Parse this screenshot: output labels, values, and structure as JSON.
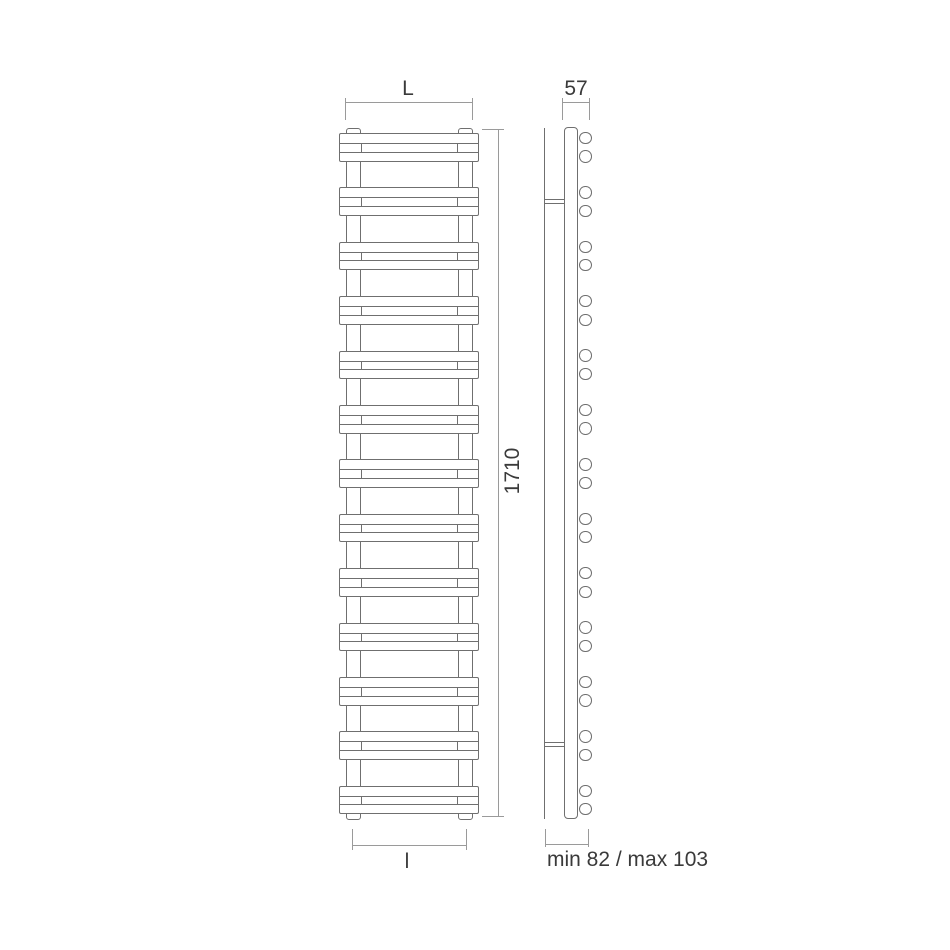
{
  "drawing": {
    "type": "technical-drawing",
    "subject": "vertical towel-warmer radiator, front elevation and side elevation with dimensions",
    "labels": {
      "width": "L",
      "height": "1710",
      "interaxis": "l",
      "depth": "57",
      "wall_distance": "min 82 / max 103"
    },
    "front_view": {
      "bar_pairs": 13,
      "bars_total": 26,
      "collectors": 2
    },
    "side_view": {
      "bar_end_circles": 26,
      "wall_brackets": 2
    },
    "colors": {
      "object_line": "#6f6f6f",
      "dimension_line": "#9a9a9a",
      "text": "#3a3a3c",
      "background": "#ffffff"
    }
  }
}
